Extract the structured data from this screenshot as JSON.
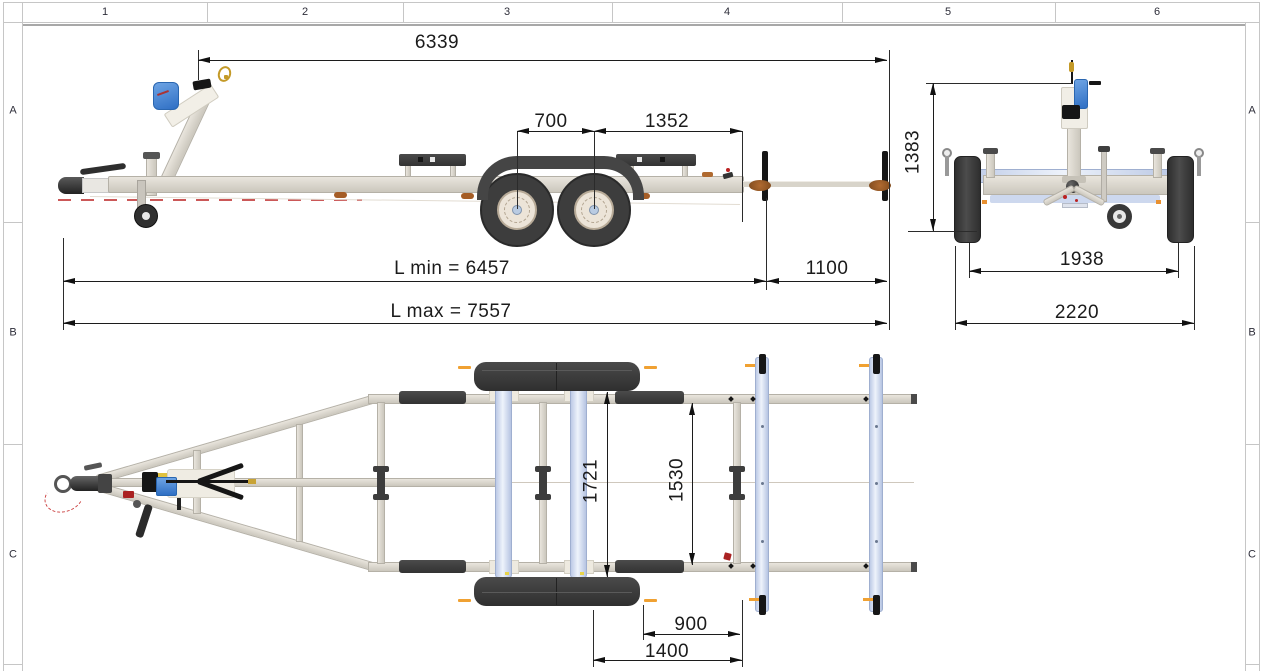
{
  "sheet": {
    "columns": [
      "1",
      "2",
      "3",
      "4",
      "5",
      "6"
    ],
    "rows": [
      "A",
      "B",
      "C"
    ]
  },
  "views": {
    "side": {
      "dims": {
        "overall": "6339",
        "axle_spacing": "700",
        "axle_to_frame_end": "1352",
        "l_min": "L min = 6457",
        "rear_extension": "1100",
        "l_max": "L max = 7557"
      }
    },
    "rear": {
      "dims": {
        "height": "1383",
        "track_width": "1938",
        "overall_width": "2220"
      }
    },
    "top": {
      "dims": {
        "frame_outer_width": "1721",
        "frame_inner_width": "1530",
        "rear_offset": "900",
        "rear_section_length": "1400"
      }
    }
  },
  "colors": {
    "frame_tan": "#d2cec5",
    "plank_blue": "#cdd9ee",
    "winch_blue": "#3f85d6",
    "tire_dark": "#3d3d3d",
    "accent_orange": "#f0a132",
    "roller_brown": "#9a5b2a",
    "dim_line": "#1c1c1c"
  }
}
